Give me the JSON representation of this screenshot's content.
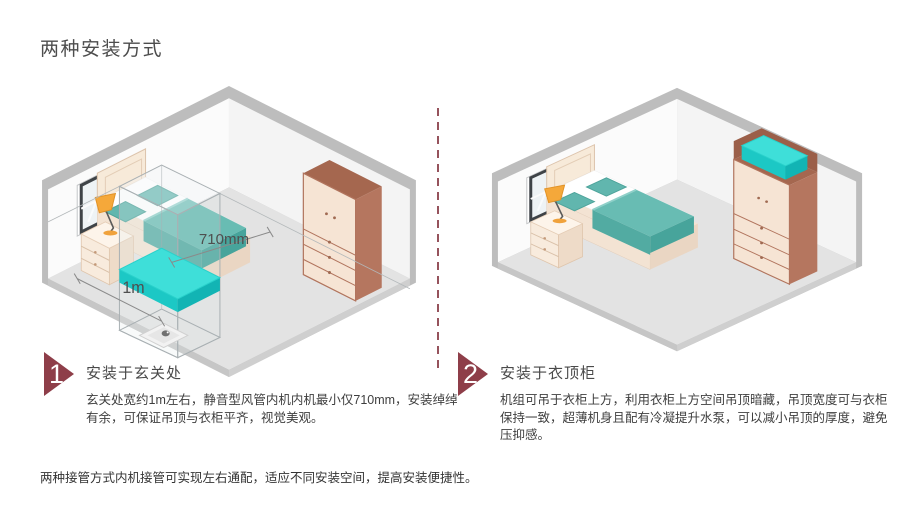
{
  "page": {
    "title": "两种安装方式",
    "footer": "两种接管方式内机接管可实现左右通配，适应不同安装空间，提高安装便捷性。"
  },
  "sections": [
    {
      "number": "1",
      "heading": "安装于玄关处",
      "body": "玄关处宽约1m左右，静音型风管内机内机最小仅710mm，安装绰绰有余，可保证吊顶与衣柜平齐，视觉美观。"
    },
    {
      "number": "2",
      "heading": "安装于衣顶柜",
      "body": "机组可吊于衣柜上方，利用衣柜上方空间吊顶暗藏，吊顶宽度可与衣柜保持一致，超薄机身且配有冷凝提升水泵，可以减小吊顶的厚度，避免压抑感。"
    }
  ],
  "diagram": {
    "hallway_room": {
      "width_label": "710mm",
      "depth_label": "1m"
    },
    "colors": {
      "accent_maroon": "#8e3e49",
      "unit_cyan": "#2ed8d2",
      "bed_teal": "#68bcb3",
      "wood_brown": "#b5765f",
      "cream": "#f6e4d4",
      "floor_gray": "#e3e3e3"
    }
  }
}
